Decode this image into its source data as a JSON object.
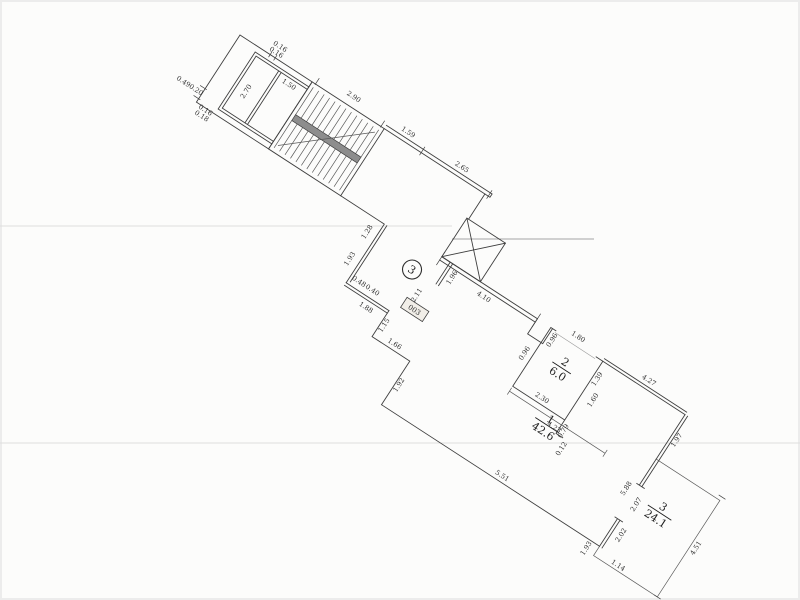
{
  "drawing": {
    "background_color": "#fcfcfb",
    "line_color": "#3f3f3f",
    "scan_artifact_color": "#a5a5a5"
  },
  "rooms": {
    "room1": {
      "number": "1",
      "area": "42.6"
    },
    "room2": {
      "number": "2",
      "area": "6.0"
    },
    "room3": {
      "number": "3",
      "area": "24.1"
    },
    "stairwell_tag": {
      "circled_number": "3",
      "room_code": "003"
    }
  },
  "dims": {
    "stairs_width": "2.90",
    "wall_159": "1.59",
    "wall_265": "2.65",
    "cell_width": "1.50",
    "cell_height": "2.70",
    "e_049": "0.49",
    "e_020": "0.20",
    "e_016a": "0.16",
    "e_016b": "0.16",
    "e_018": "0.18",
    "e_016c": "0.16",
    "corr_128": "1.28",
    "corr_193": "1.93",
    "shaft_196": "1.96",
    "land_211": "2.11",
    "w_410": "4.10",
    "niche_096": "0.96",
    "door_180": "1.80",
    "r2_096": "0.96",
    "r2_230": "2.30",
    "r2_423": "4.23",
    "r2_139": "1.39",
    "r2_160": "1.60",
    "r2_079": "0.79",
    "r2_012": "0.12",
    "z_048": "0.48",
    "z_040": "0.40",
    "z_188": "1.88",
    "z_115": "1.15",
    "z_166": "1.66",
    "z_192": "1.92",
    "r1_551": "5.51",
    "r1_427": "4.27",
    "r1_197": "1.97",
    "w13_588": "5.88",
    "w13_207": "2.07",
    "w13_202": "2.02",
    "r3_193": "1.93",
    "r3_114": "1.14",
    "r3_451": "4.51"
  }
}
